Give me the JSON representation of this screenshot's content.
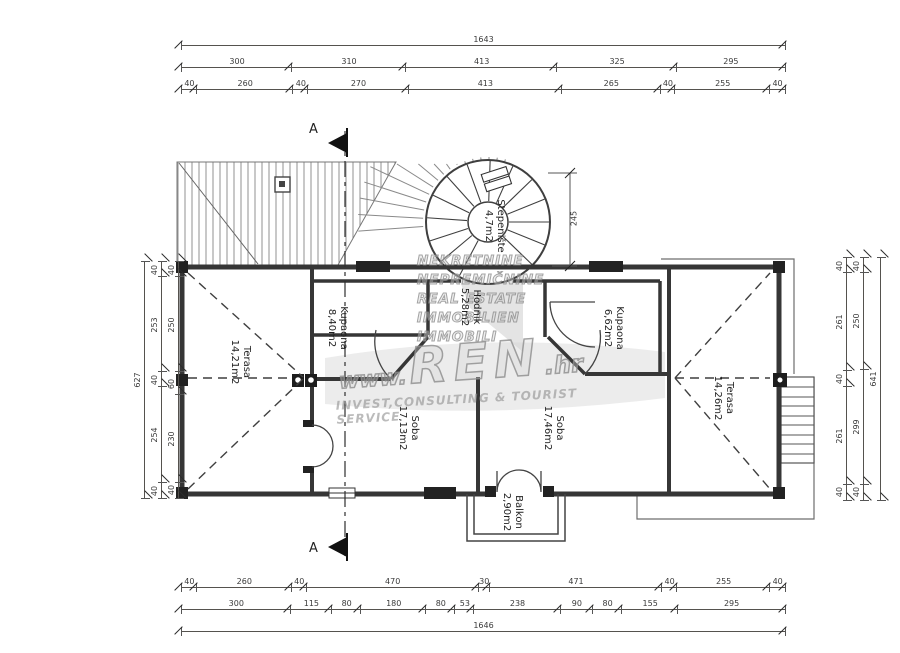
{
  "section": {
    "label": "A"
  },
  "rooms": {
    "terasa_left": {
      "name": "Terasa",
      "area": "14,21m2"
    },
    "kupaona_left": {
      "name": "Kupaona",
      "area": "8,40m2"
    },
    "hodnik": {
      "name": "Hodnik",
      "area": "5,28m2"
    },
    "stepeniste": {
      "name": "Stepenište",
      "area": "4,7m2"
    },
    "kupaona_right": {
      "name": "Kupaona",
      "area": "6,62m2"
    },
    "soba_left": {
      "name": "Soba",
      "area": "17,13m2"
    },
    "soba_right": {
      "name": "Soba",
      "area": "17,46m2"
    },
    "terasa_right": {
      "name": "Terasa",
      "area": "14,26m2"
    },
    "balkon": {
      "name": "Balkon",
      "area": "2,90m2"
    }
  },
  "dimensions": {
    "top": {
      "total": [
        "1643"
      ],
      "row2": [
        "300",
        "310",
        "413",
        "325",
        "295"
      ],
      "row3": [
        "40",
        "260",
        "40",
        "270",
        "413",
        "265",
        "40",
        "255",
        "40"
      ]
    },
    "bottom": {
      "row1": [
        "40",
        "260",
        "40",
        "470",
        "30",
        "471",
        "40",
        "255",
        "40"
      ],
      "row2": [
        "300",
        "115",
        "80",
        "180",
        "80",
        "53",
        "238",
        "90",
        "80",
        "155",
        "295"
      ],
      "total": [
        "1646"
      ]
    },
    "left": {
      "total": [
        "627"
      ],
      "mid": [
        "40",
        "253",
        "40",
        "254",
        "40"
      ],
      "inner": [
        "40",
        "250",
        "60",
        "230",
        "40"
      ]
    },
    "right": {
      "inner": [
        "40",
        "261",
        "40",
        "261",
        "40"
      ],
      "mid": [
        "40",
        "250",
        "299",
        "40"
      ],
      "total": [
        "641"
      ]
    },
    "stair": [
      "245"
    ]
  },
  "watermark": {
    "lines": [
      "NEKRETNINE",
      "NEPREMIČNINE",
      "REAL ESTATE",
      "IMMOBILIEN",
      "IMMOBILI"
    ],
    "www": "www.",
    "brand": "REN",
    "tld": ".hr",
    "tagline": "INVEST,CONSULTING & TOURIST SERVICE"
  }
}
